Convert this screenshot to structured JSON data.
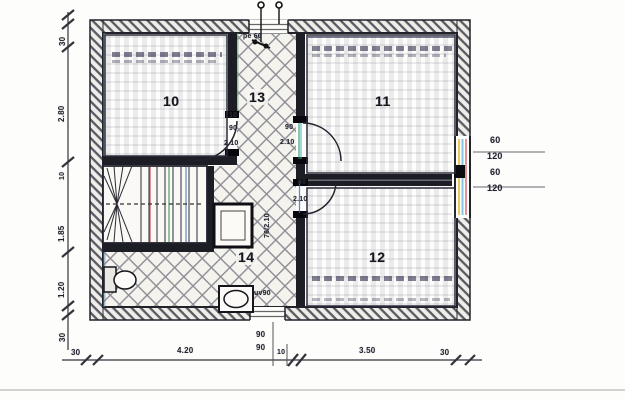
{
  "document_type": "scanned floor plan",
  "colors": {
    "paper": "#fdfdfb",
    "ink": "#23232e",
    "wall_fill": "#1d1d26",
    "hatch_gray": "#5a5a64",
    "tile_gray": "#8d8d95",
    "artifact_red": "#bb3333",
    "artifact_green": "#2a8f3a",
    "artifact_blue": "#3a6fc0"
  },
  "rooms": {
    "r10": "10",
    "r11": "11",
    "r12": "12",
    "r13": "13",
    "r14": "14"
  },
  "doors": {
    "left_small": "10",
    "left_width": "90",
    "left_height": "2.10",
    "top_right_width": "90",
    "top_right_height": "2.10",
    "bottom_right_width": "90",
    "bottom_right_height": "2.10",
    "bath": "76/2.10"
  },
  "windows": {
    "top": "pe 60",
    "bottom": "uv90"
  },
  "dims": {
    "left": [
      "30",
      "2.80",
      "10",
      "1.85",
      "1.20",
      "30"
    ],
    "bottom": [
      "30",
      "4.20",
      "90",
      "90",
      "10",
      "3.50",
      "30"
    ],
    "right": [
      "60",
      "120",
      "60",
      "120"
    ]
  }
}
